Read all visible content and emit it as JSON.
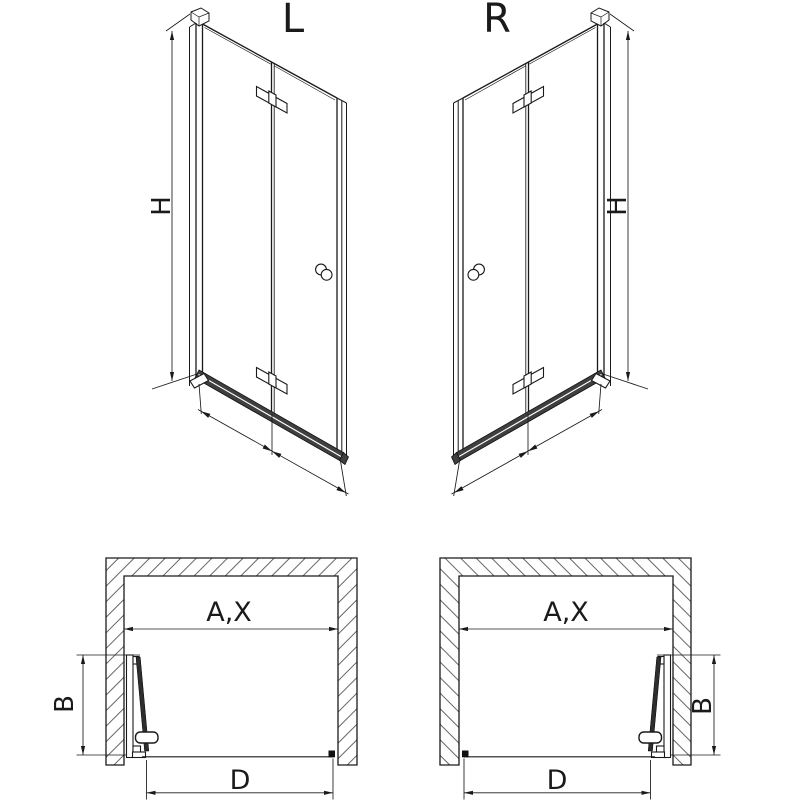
{
  "page": {
    "background_color": "#ffffff",
    "line_color": "#1a1a1a",
    "description_labels_only": true
  },
  "perspective_views": [
    {
      "variant_label": "L",
      "height_dim": "H",
      "fixed_panel_dim": "F",
      "door_panel_dim": "E"
    },
    {
      "variant_label": "R",
      "height_dim": "H",
      "fixed_panel_dim": "F",
      "door_panel_dim": "E"
    }
  ],
  "plan_views": [
    {
      "opening_width_dim": "A,X",
      "fold_depth_dim": "B",
      "entry_width_dim": "D"
    },
    {
      "opening_width_dim": "A,X",
      "fold_depth_dim": "B",
      "entry_width_dim": "D"
    }
  ]
}
